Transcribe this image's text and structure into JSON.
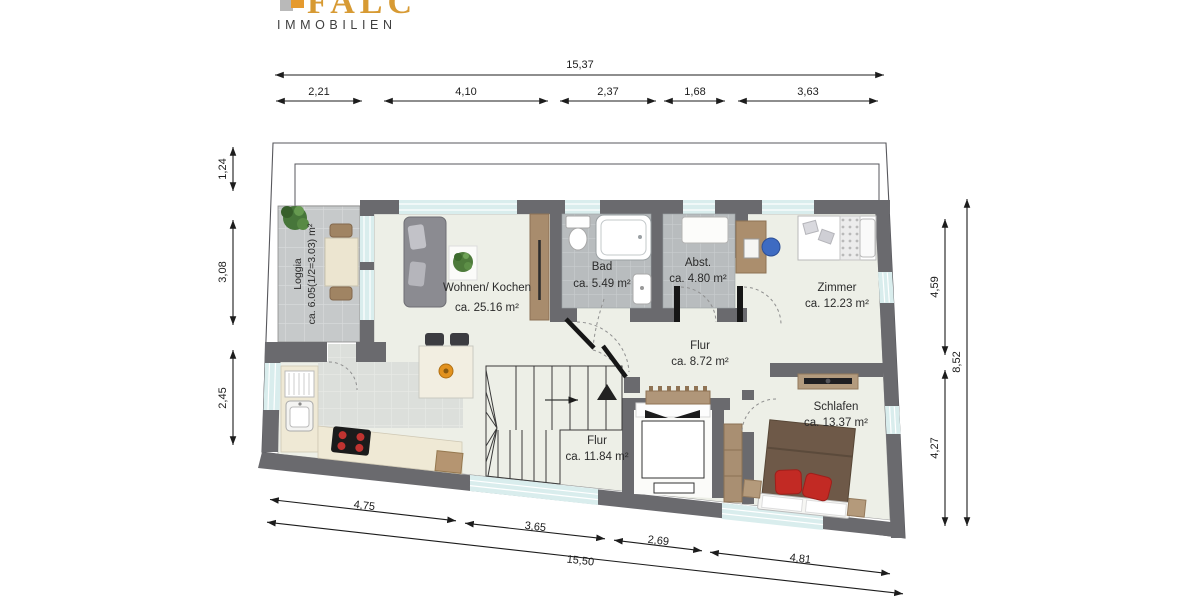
{
  "brand": {
    "name": "FALC",
    "subtitle": "IMMOBILIEN"
  },
  "rooms": [
    {
      "id": "loggia",
      "name": "Loggia",
      "area": "ca. 6.05(1/2=3.03) m²"
    },
    {
      "id": "wohnen",
      "name": "Wohnen/ Kochen",
      "area": "ca. 25.16 m²"
    },
    {
      "id": "bad",
      "name": "Bad",
      "area": "ca. 5.49 m²"
    },
    {
      "id": "abstellraum",
      "name": "Abst.",
      "area": "ca. 4.80 m²"
    },
    {
      "id": "zimmer",
      "name": "Zimmer",
      "area": "ca. 12.23 m²"
    },
    {
      "id": "flur-og",
      "name": "Flur",
      "area": "ca. 8.72 m²"
    },
    {
      "id": "flur-treppe",
      "name": "Flur",
      "area": "ca. 11.84 m²"
    },
    {
      "id": "schlafen",
      "name": "Schlafen",
      "area": "ca. 13.37 m²"
    }
  ],
  "dims": {
    "top_total": "15,37",
    "top_segments": [
      "2,21",
      "4,10",
      "2,37",
      "1,68",
      "3,63"
    ],
    "left_segments": [
      "1,24",
      "3,08",
      "2,45"
    ],
    "right_segments": [
      "4,59",
      "4,27"
    ],
    "right_total": "8,52",
    "bottom_segments": [
      "4,75",
      "3,65",
      "2,69",
      "4,81"
    ],
    "bottom_total": "15,50"
  },
  "colors": {
    "wall": "#6a6a6e",
    "floor": "#edefe7",
    "bath_tile": "#b8bcbe",
    "loggia_tile": "#c6c9ca",
    "window": "#d9eded",
    "dimension_line": "#1c1c1c",
    "logo_orange": "#d79a33",
    "logo_gray": "#3f3f3f",
    "wood": "#a98e6f",
    "bed_brown": "#6e5948",
    "pillow_red": "#c22a24",
    "chair_blue": "#3e6bc2"
  }
}
